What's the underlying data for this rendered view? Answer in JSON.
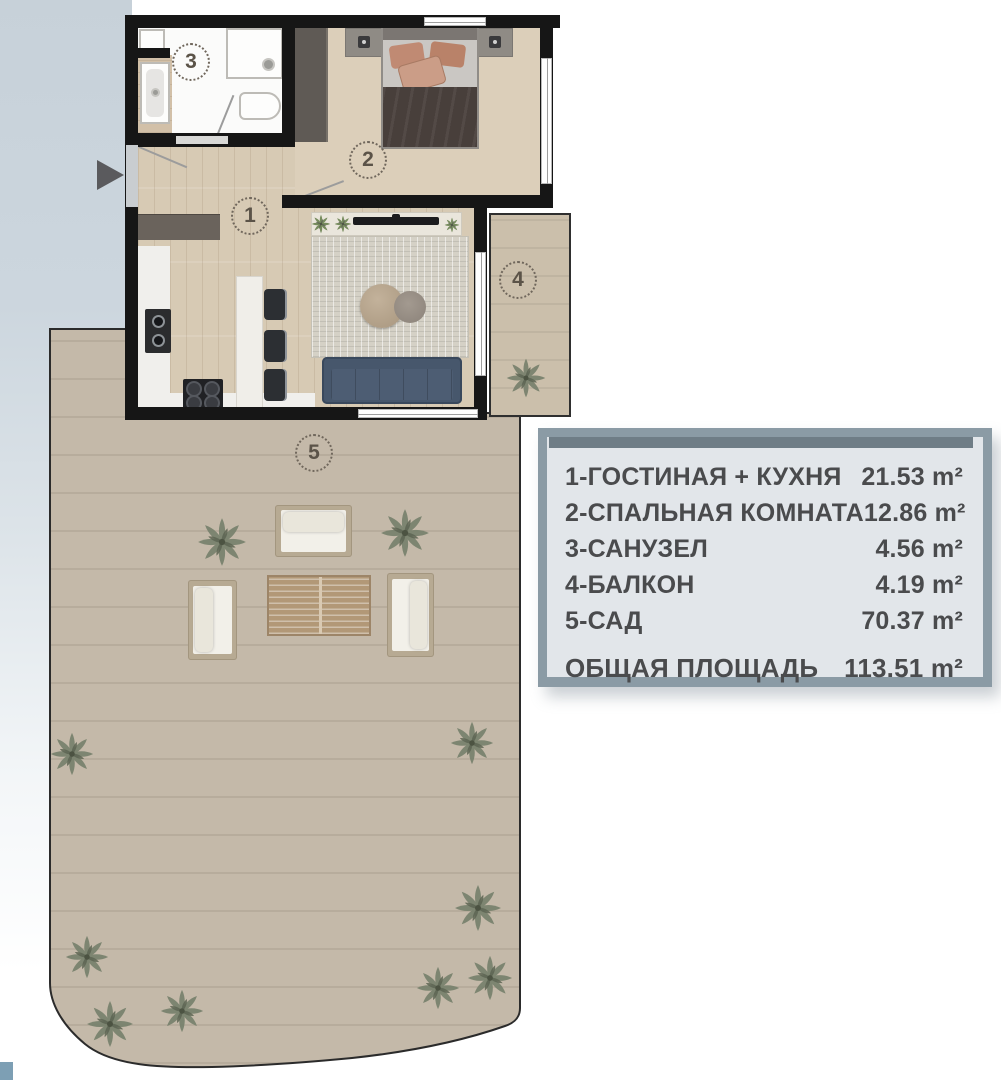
{
  "plan": {
    "rooms": {
      "living": {
        "number": "1"
      },
      "bedroom": {
        "number": "2"
      },
      "bath": {
        "number": "3"
      },
      "balcony": {
        "number": "4"
      },
      "garden": {
        "number": "5"
      }
    }
  },
  "legend": {
    "items": [
      {
        "label": "1-ГОСТИНАЯ + КУХНЯ",
        "value": "21.53 m²"
      },
      {
        "label": "2-СПАЛЬНАЯ КОМНАТА",
        "value": "12.86 m²"
      },
      {
        "label": "3-САНУЗЕЛ",
        "value": "4.56 m²"
      },
      {
        "label": "4-БАЛКОН",
        "value": "4.19 m²"
      },
      {
        "label": "5-САД",
        "value": "70.37 m²"
      }
    ],
    "total_label": "ОБЩАЯ ПЛОЩАДЬ",
    "total_value": "113.51 m²"
  },
  "colors": {
    "wall": "#161616",
    "wood_floor": "#d7cab4",
    "terrace": "#c4b9a9",
    "sofa_blue": "#47576c",
    "legend_frame": "#8b9ba5",
    "legend_bg": "#e2e6ea",
    "legend_bar": "#6f7d86",
    "legend_text": "#4a4b4d",
    "gradient_band": "#c7d1d9",
    "plant_green": "#78816d"
  }
}
